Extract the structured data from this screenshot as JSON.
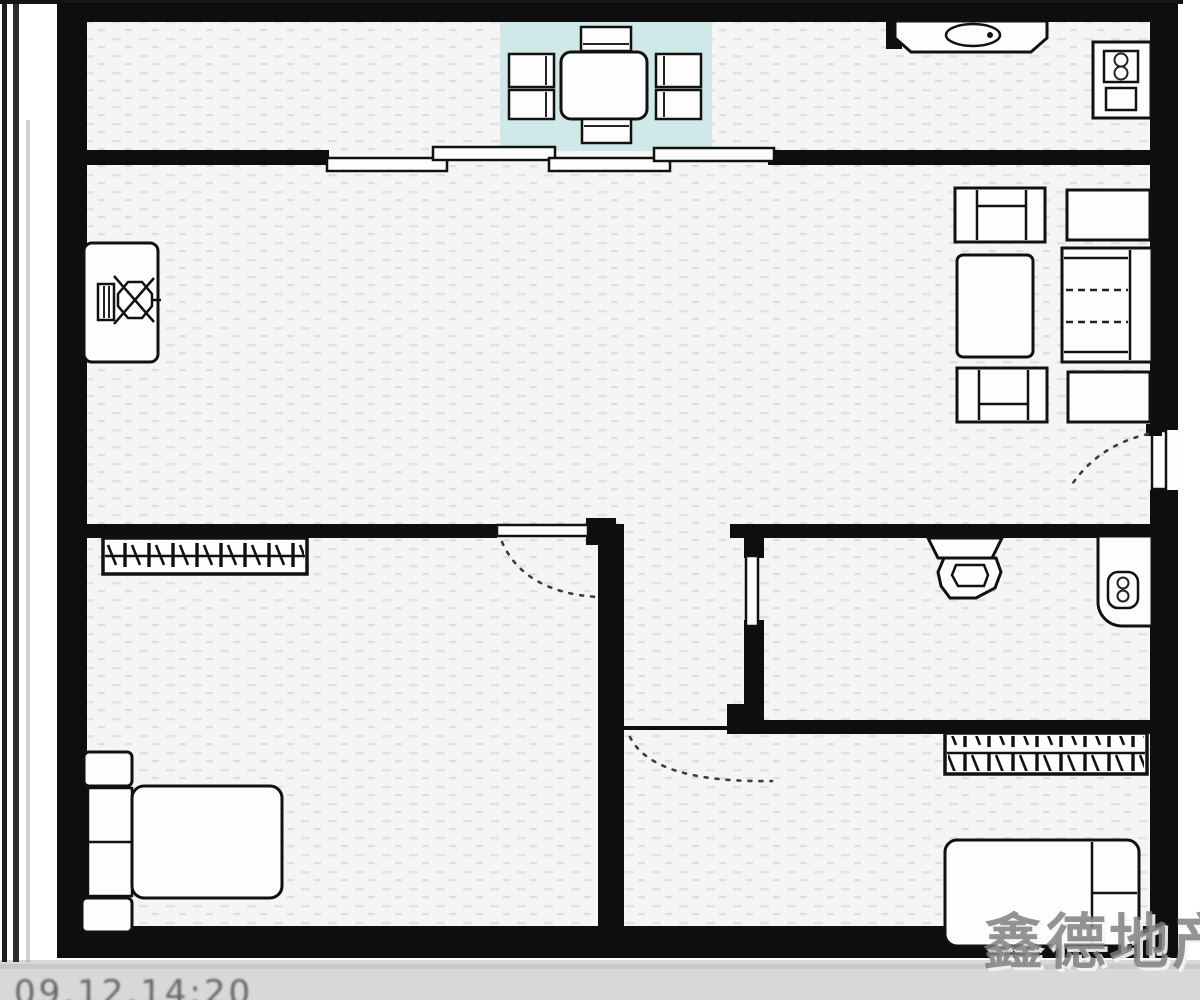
{
  "meta": {
    "title": "apartment-floor-plan-photo",
    "canvas": {
      "width": 1200,
      "height": 1000
    }
  },
  "watermark": {
    "text": "鑫德地产"
  },
  "photo_strip": {
    "timestamp": "09.12.14:20"
  },
  "colors": {
    "wall": "#0e0e0e",
    "line": "#111111",
    "dining_floor": "#cfe8e8",
    "floor_base": "#f5f5f3",
    "photo_strip": "#d8d8d6",
    "watermark_gray": "#7d7d7d"
  },
  "symbols": [
    "dining-table",
    "dining-chair",
    "sliding-door-panel",
    "kitchen-sink",
    "cooktop",
    "tv-cabinet",
    "armchair",
    "coffee-table",
    "sofa",
    "side-table",
    "entry-door-swing",
    "toilet",
    "washbasin",
    "interior-door-swing",
    "wardrobe",
    "bed",
    "nightstand",
    "pillow"
  ]
}
